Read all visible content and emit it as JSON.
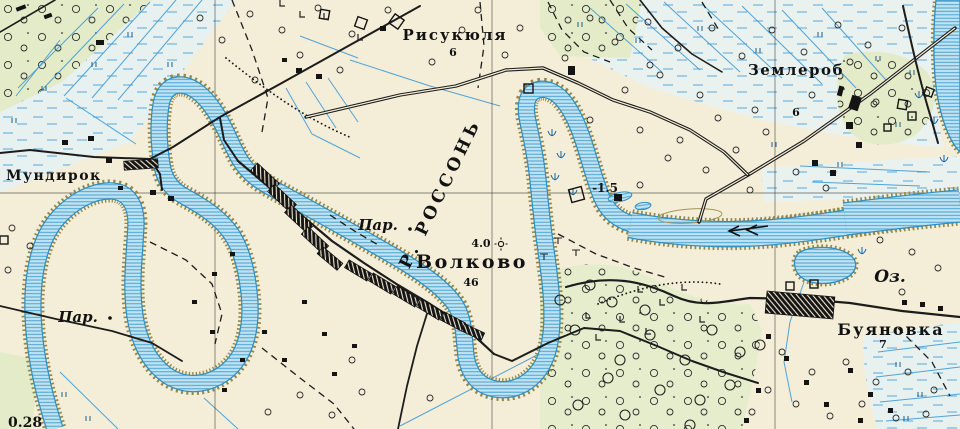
{
  "colors": {
    "background": "#f4eed8",
    "vegetation": "#e3ebc8",
    "marsh_tint": "#e7f1ef",
    "water_fill": "#bfe3f2",
    "water_line": "#2e8fc0",
    "bank": "#97874a",
    "ditch": "#3f9ad6",
    "ink": "#1a1a1a"
  },
  "labels": {
    "river": "Р. РОССОНЬ",
    "ferry_west": "Пар.",
    "ferry_center": "Пар.",
    "lake": "Оз."
  },
  "settlements": {
    "risukyulya": {
      "name": "Рисукюля",
      "number": "6"
    },
    "zemlerob": {
      "name": "Землероб",
      "number": "6"
    },
    "mundirok": {
      "name": "Мундирок"
    },
    "volkovo": {
      "name": "Волково",
      "number": "46",
      "spot_height": "4.0"
    },
    "buyanovka": {
      "name": "Буяновка",
      "number": "7"
    }
  },
  "marks": {
    "depth": "-1.5",
    "bottom_left_value": "0.28"
  }
}
